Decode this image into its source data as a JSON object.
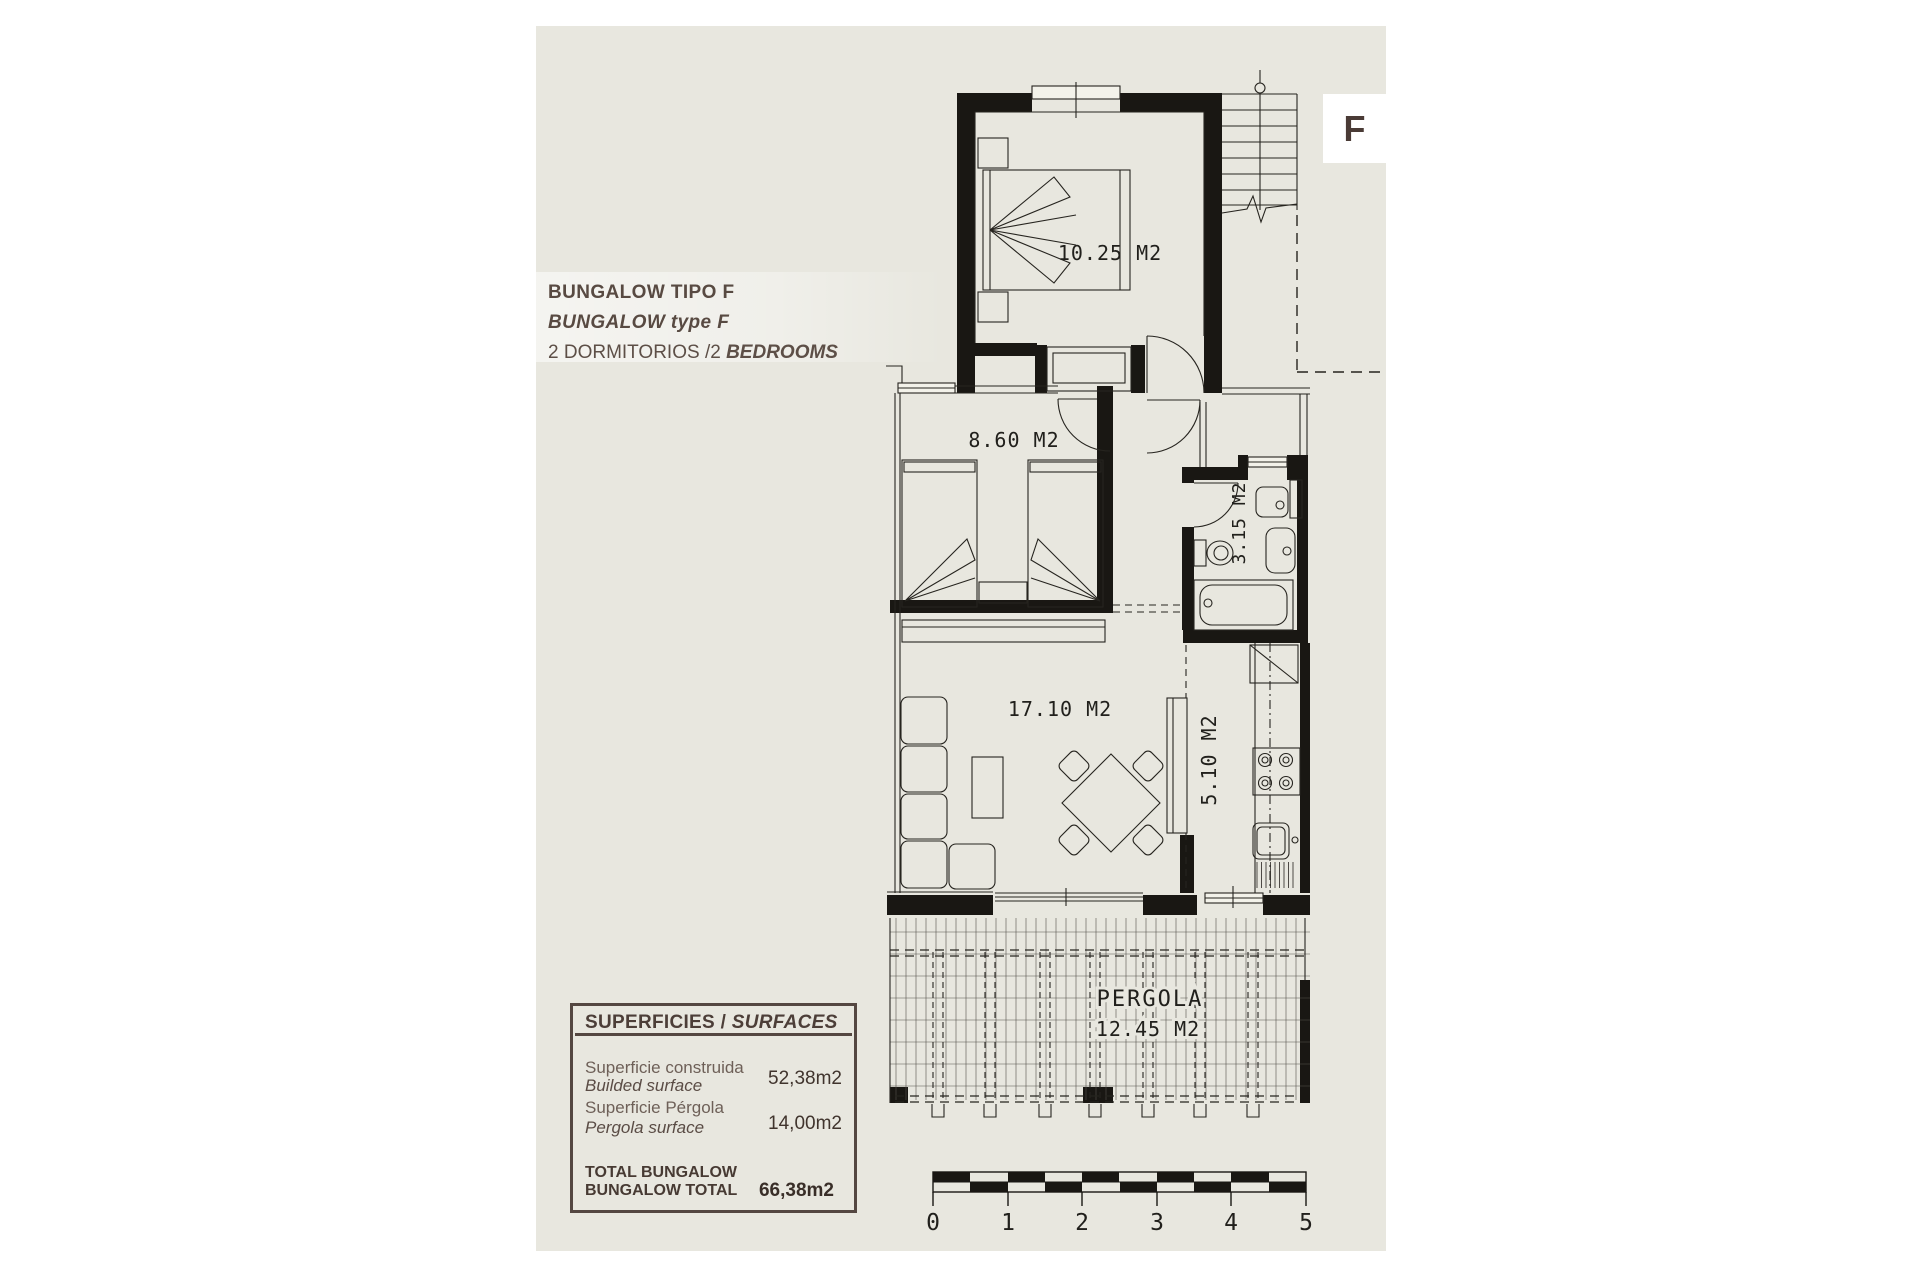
{
  "plan": {
    "letter": "F",
    "title": {
      "line1": "BUNGALOW TIPO F",
      "line2": "BUNGALOW type F",
      "line3_prefix": "2 DORMITORIOS /2 ",
      "line3_bold": "BEDROOMS"
    },
    "rooms": {
      "bedroom_main": "10.25 M2",
      "bedroom_second": "8.60 M2",
      "bathroom": "3.15 M2",
      "living": "17.10 M2",
      "kitchen": "5.10 M2",
      "pergola_name": "PERGOLA",
      "pergola_area": "12.45 M2"
    },
    "scale": {
      "ticks": [
        "0",
        "1",
        "2",
        "3",
        "4",
        "5"
      ]
    },
    "surfaces": {
      "header_primary": "SUPERFICIES / ",
      "header_secondary": "SURFACES",
      "rows": [
        {
          "es": "Superficie construida",
          "en": "Builded surface",
          "value": "52,38m2"
        },
        {
          "es": "Superficie Pérgola",
          "en": "Pergola surface",
          "value": "14,00m2"
        }
      ],
      "total_es": "TOTAL BUNGALOW",
      "total_en": "BUNGALOW TOTAL",
      "total_value": "66,38m2"
    },
    "colors": {
      "paper": "#e8e7df",
      "ink": "#21201c",
      "text": "#584a42"
    }
  }
}
